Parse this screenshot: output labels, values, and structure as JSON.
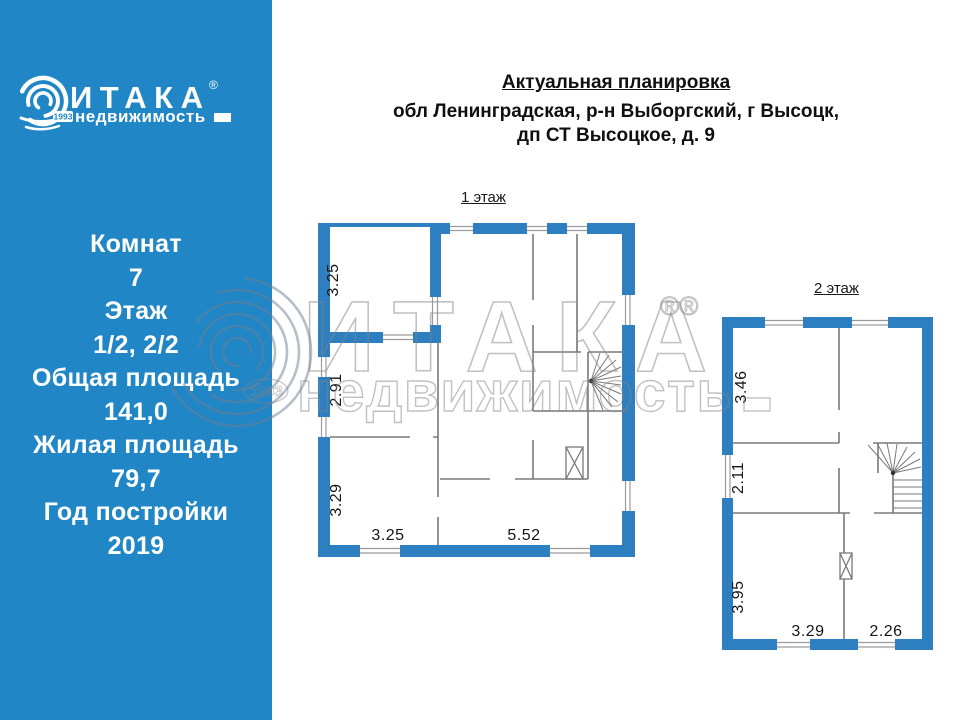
{
  "brand": {
    "title": "ИТАКА",
    "reg": "®",
    "subtitle": "недвижимость",
    "year_badge": "1993"
  },
  "sidebar": {
    "stats": [
      {
        "label": "Комнат",
        "value": "7"
      },
      {
        "label": "Этаж",
        "value": "1/2, 2/2"
      },
      {
        "label": "Общая площадь",
        "value": "141,0"
      },
      {
        "label": "Жилая площадь",
        "value": "79,7"
      },
      {
        "label": "Год постройки",
        "value": "2019"
      }
    ]
  },
  "header": {
    "title": "Актуальная планировка",
    "address_line1": "обл Ленинградская, р-н Выборгский, г Высоцк,",
    "address_line2": "дп СТ Высоцкое, д. 9"
  },
  "floors": {
    "floor1": {
      "label": "1 этаж",
      "dims": {
        "v1": "3.25",
        "v2": "2.91",
        "v3": "3.29",
        "h1": "3.25",
        "h2": "5.52"
      }
    },
    "floor2": {
      "label": "2 этаж",
      "dims": {
        "v1": "3.46",
        "v2": "2.11",
        "v3": "3.95",
        "h1": "3.29",
        "h2": "2.26"
      }
    }
  },
  "watermark": {
    "title": "ИТАКА",
    "subtitle": "недвижимость",
    "reg_marks": "®®",
    "year": "1993"
  },
  "colors": {
    "sidebar_blue": "#2086c6",
    "wall_blue": "#2e7fc0",
    "watermark_gray": "#858585"
  }
}
